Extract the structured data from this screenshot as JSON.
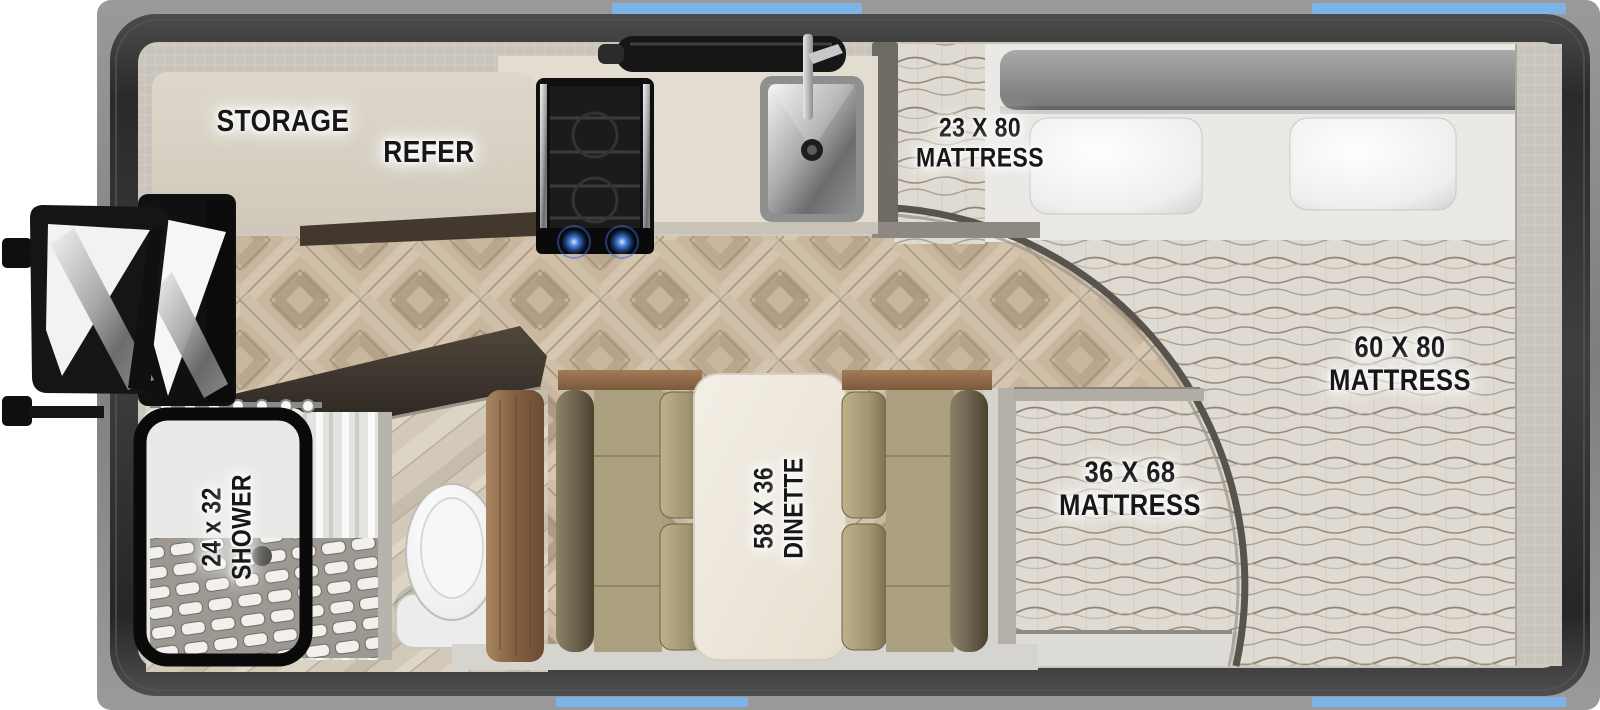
{
  "floorplan": {
    "labels": {
      "storage": "STORAGE",
      "refer": "REFER",
      "bunk_l1": "23 X 80",
      "bunk_l2": "MATTRESS",
      "queen_l1": "60 X 80",
      "queen_l2": "MATTRESS",
      "mid_l1": "36 X 68",
      "mid_l2": "MATTRESS",
      "dinette_l1": "58 X 36",
      "dinette_l2": "DINETTE",
      "shower_l1": "24 x 32",
      "shower_l2": "SHOWER"
    },
    "colors": {
      "window_blue": "#7db4e8",
      "shell_gray": "#8b8b8b",
      "frame_dark": "#363636",
      "floor_wood": "#c8b69e",
      "counter_beige": "#d9d3c7",
      "cushion_olive": "#a59b79",
      "wood_trim": "#8a6a4c",
      "mattress_fabric": "#ddd8d0",
      "label_ink": "#171717"
    }
  }
}
